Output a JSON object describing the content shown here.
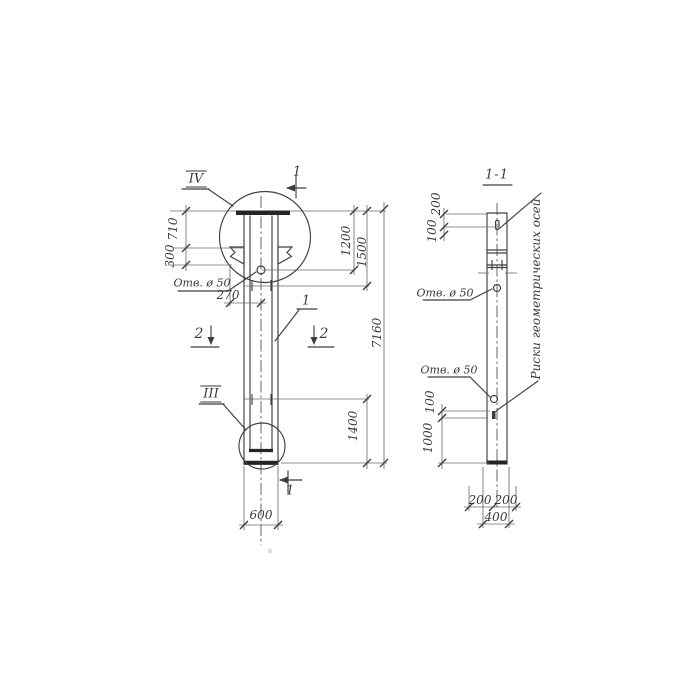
{
  "canvas": {
    "background": "#ffffff",
    "ink_color": "#3a3a3a"
  },
  "elevation_view": {
    "detail_circle_top_label": "IV",
    "detail_circle_bottom_label": "III",
    "shaft_part_label": "1",
    "section_2_left": "2",
    "section_2_right": "2",
    "section_1_top": "1",
    "section_1_bottom": "1",
    "hole_label": "Отв. ø 50",
    "dim_710": "710",
    "dim_300": "300",
    "dim_270": "270",
    "dim_1200": "1200",
    "dim_1500": "1500",
    "dim_7160": "7160",
    "dim_1400": "1400",
    "dim_600": "600"
  },
  "section_view": {
    "title": "1-1",
    "hole_label_upper": "Отв. ø 50",
    "hole_label_lower": "Отв. ø 50",
    "axes_note": "Риски геометрических осей",
    "dim_200_top": "200",
    "dim_100_upper": "100",
    "dim_100_lower": "100",
    "dim_1000": "1000",
    "dim_200_left": "200",
    "dim_200_right": "200",
    "dim_400": "400"
  }
}
